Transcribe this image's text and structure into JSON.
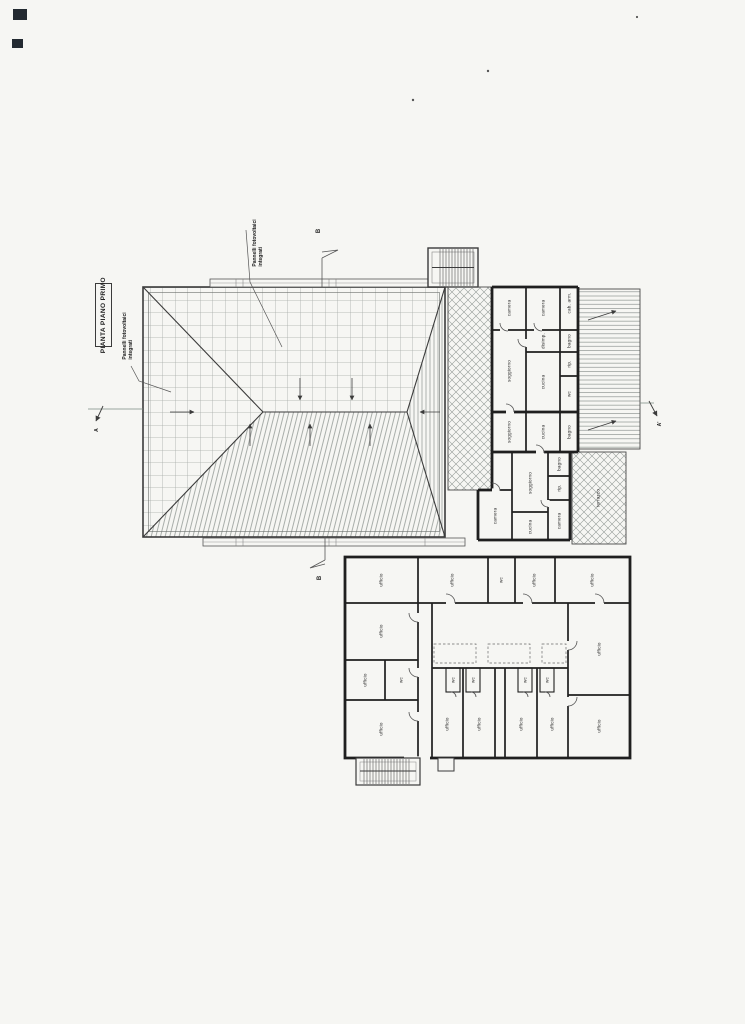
{
  "page": {
    "background": "#f6f6f3",
    "ink": "#3b3b3b",
    "wall": "#1f1f1f",
    "hatch": "#8f9592"
  },
  "title_box": {
    "label": "PIANTA PIANO PRIMO"
  },
  "annotations": {
    "pv_top": {
      "line1": "Pannelli fotovoltaici",
      "line2": "integrati"
    },
    "pv_left": {
      "line1": "Pannelli fotovoltaici",
      "line2": "integrati"
    }
  },
  "section_markers": {
    "a_left": "A",
    "a_right": "A'",
    "b_top": "B",
    "b_bottom": "B"
  },
  "terrace": {
    "label": "terrazzo"
  },
  "rooms_right": [
    {
      "label": "camera",
      "x": 509,
      "y": 308
    },
    {
      "label": "camera",
      "x": 543,
      "y": 308
    },
    {
      "label": "cab. arm.",
      "x": 569,
      "y": 303
    },
    {
      "label": "bagno",
      "x": 569,
      "y": 341
    },
    {
      "label": "disimp.",
      "x": 543,
      "y": 341
    },
    {
      "label": "cucina",
      "x": 543,
      "y": 382
    },
    {
      "label": "soggiorno",
      "x": 509,
      "y": 371
    },
    {
      "label": "rip.",
      "x": 569,
      "y": 364
    },
    {
      "label": "wc",
      "x": 569,
      "y": 394
    },
    {
      "label": "soggiorno",
      "x": 509,
      "y": 432
    },
    {
      "label": "cucina",
      "x": 543,
      "y": 432
    },
    {
      "label": "bagno",
      "x": 569,
      "y": 432
    },
    {
      "label": "soggiorno",
      "x": 530,
      "y": 483
    },
    {
      "label": "bagno",
      "x": 559,
      "y": 464
    },
    {
      "label": "rip.",
      "x": 559,
      "y": 488
    },
    {
      "label": "camera",
      "x": 559,
      "y": 521
    },
    {
      "label": "cucina",
      "x": 530,
      "y": 527
    },
    {
      "label": "camera",
      "x": 495,
      "y": 516
    }
  ],
  "rooms_bottom": [
    {
      "label": "ufficio",
      "x": 381,
      "y": 580
    },
    {
      "label": "ufficio",
      "x": 452,
      "y": 580
    },
    {
      "label": "wc",
      "x": 501,
      "y": 580
    },
    {
      "label": "ufficio",
      "x": 534,
      "y": 580
    },
    {
      "label": "ufficio",
      "x": 592,
      "y": 580
    },
    {
      "label": "ufficio",
      "x": 381,
      "y": 631
    },
    {
      "label": "ufficio",
      "x": 365,
      "y": 680
    },
    {
      "label": "wc",
      "x": 401,
      "y": 680
    },
    {
      "label": "ufficio",
      "x": 381,
      "y": 729
    },
    {
      "label": "ufficio",
      "x": 447,
      "y": 724
    },
    {
      "label": "ufficio",
      "x": 479,
      "y": 724
    },
    {
      "label": "ufficio",
      "x": 521,
      "y": 724
    },
    {
      "label": "ufficio",
      "x": 552,
      "y": 724
    },
    {
      "label": "ufficio",
      "x": 599,
      "y": 649
    },
    {
      "label": "ufficio",
      "x": 599,
      "y": 726
    },
    {
      "label": "wc",
      "x": 453,
      "y": 680
    },
    {
      "label": "wc",
      "x": 473,
      "y": 680
    },
    {
      "label": "wc",
      "x": 525,
      "y": 680
    },
    {
      "label": "wc",
      "x": 547,
      "y": 680
    }
  ]
}
